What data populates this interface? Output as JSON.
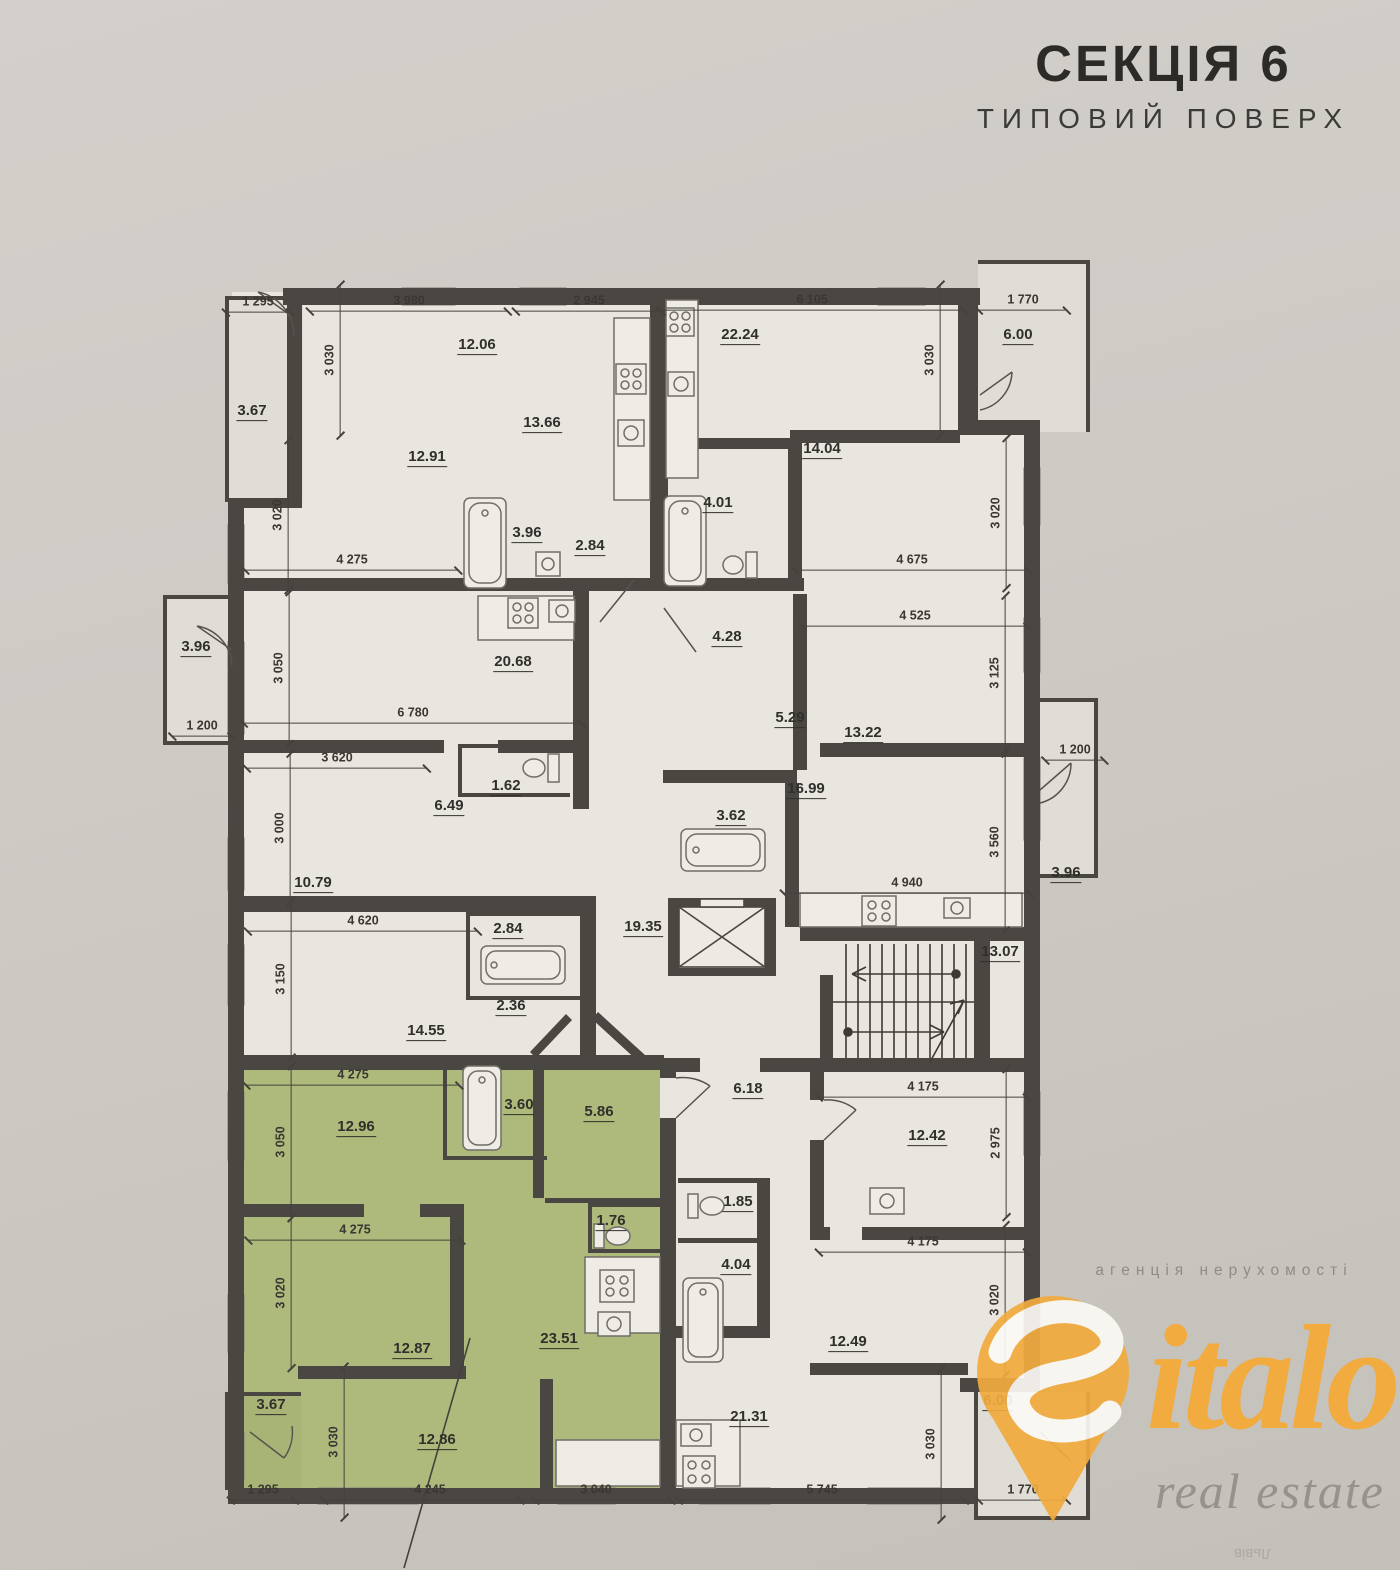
{
  "title": {
    "section": "СЕКЦІЯ 6",
    "floor_type": "ТИПОВИЙ ПОВЕРХ"
  },
  "watermark": {
    "agency_line": "агенція нерухомості",
    "brand_full": "Sitalo",
    "brand_rest": "italo",
    "tagline": "real estate",
    "city": "Львів"
  },
  "colors": {
    "wall": "#4a4642",
    "plan_bg": "#e9e6e0",
    "balcony_bg": "#e0ddd7",
    "paper": "#ccc8c2",
    "highlight_green": "#aeb97c",
    "brand_orange": "#f2ab3e"
  },
  "plan": {
    "room_areas": [
      {
        "t": "12.06",
        "x": 477,
        "y": 346
      },
      {
        "t": "13.66",
        "x": 542,
        "y": 424
      },
      {
        "t": "12.91",
        "x": 427,
        "y": 458
      },
      {
        "t": "3.96",
        "x": 527,
        "y": 534
      },
      {
        "t": "2.84",
        "x": 590,
        "y": 547
      },
      {
        "t": "3.67",
        "x": 252,
        "y": 412
      },
      {
        "t": "22.24",
        "x": 740,
        "y": 336
      },
      {
        "t": "14.04",
        "x": 822,
        "y": 450
      },
      {
        "t": "4.01",
        "x": 718,
        "y": 504
      },
      {
        "t": "6.00",
        "x": 1018,
        "y": 336
      },
      {
        "t": "4.28",
        "x": 727,
        "y": 638
      },
      {
        "t": "5.29",
        "x": 790,
        "y": 719
      },
      {
        "t": "13.22",
        "x": 863,
        "y": 734
      },
      {
        "t": "16.99",
        "x": 806,
        "y": 790
      },
      {
        "t": "3.62",
        "x": 731,
        "y": 817
      },
      {
        "t": "3.96",
        "x": 1066,
        "y": 874
      },
      {
        "t": "20.68",
        "x": 513,
        "y": 663
      },
      {
        "t": "1.62",
        "x": 506,
        "y": 787
      },
      {
        "t": "6.49",
        "x": 449,
        "y": 807
      },
      {
        "t": "10.79",
        "x": 313,
        "y": 884
      },
      {
        "t": "3.96",
        "x": 196,
        "y": 648
      },
      {
        "t": "14.55",
        "x": 426,
        "y": 1032
      },
      {
        "t": "2.84",
        "x": 508,
        "y": 930
      },
      {
        "t": "2.36",
        "x": 511,
        "y": 1007
      },
      {
        "t": "19.35",
        "x": 643,
        "y": 928
      },
      {
        "t": "13.07",
        "x": 1000,
        "y": 953
      },
      {
        "t": "12.96",
        "x": 356,
        "y": 1128
      },
      {
        "t": "3.60",
        "x": 519,
        "y": 1106
      },
      {
        "t": "5.86",
        "x": 599,
        "y": 1113
      },
      {
        "t": "1.76",
        "x": 611,
        "y": 1222
      },
      {
        "t": "12.87",
        "x": 412,
        "y": 1350
      },
      {
        "t": "23.51",
        "x": 559,
        "y": 1340
      },
      {
        "t": "12.86",
        "x": 437,
        "y": 1441
      },
      {
        "t": "3.67",
        "x": 271,
        "y": 1406
      },
      {
        "t": "6.18",
        "x": 748,
        "y": 1090
      },
      {
        "t": "1.85",
        "x": 738,
        "y": 1203
      },
      {
        "t": "4.04",
        "x": 736,
        "y": 1266
      },
      {
        "t": "12.42",
        "x": 927,
        "y": 1137
      },
      {
        "t": "12.49",
        "x": 848,
        "y": 1343
      },
      {
        "t": "21.31",
        "x": 749,
        "y": 1418
      },
      {
        "t": "6.00",
        "x": 998,
        "y": 1402
      }
    ],
    "dimensions": [
      {
        "t": "1 295",
        "x": 258,
        "y": 304,
        "o": "h"
      },
      {
        "t": "3 980",
        "x": 409,
        "y": 303,
        "o": "h"
      },
      {
        "t": "2 945",
        "x": 589,
        "y": 303,
        "o": "h"
      },
      {
        "t": "6 105",
        "x": 812,
        "y": 302,
        "o": "h"
      },
      {
        "t": "1 770",
        "x": 1023,
        "y": 302,
        "o": "h"
      },
      {
        "t": "4 275",
        "x": 352,
        "y": 562,
        "o": "h"
      },
      {
        "t": "4 675",
        "x": 912,
        "y": 562,
        "o": "h"
      },
      {
        "t": "4 525",
        "x": 915,
        "y": 618,
        "o": "h"
      },
      {
        "t": "6 780",
        "x": 413,
        "y": 715,
        "o": "h"
      },
      {
        "t": "3 620",
        "x": 337,
        "y": 760,
        "o": "h"
      },
      {
        "t": "1 200",
        "x": 202,
        "y": 728,
        "o": "h"
      },
      {
        "t": "1 200",
        "x": 1075,
        "y": 752,
        "o": "h"
      },
      {
        "t": "4 620",
        "x": 363,
        "y": 923,
        "o": "h"
      },
      {
        "t": "4 940",
        "x": 907,
        "y": 885,
        "o": "h"
      },
      {
        "t": "4 275",
        "x": 353,
        "y": 1077,
        "o": "h"
      },
      {
        "t": "4 175",
        "x": 923,
        "y": 1089,
        "o": "h"
      },
      {
        "t": "4 275",
        "x": 355,
        "y": 1232,
        "o": "h"
      },
      {
        "t": "4 175",
        "x": 923,
        "y": 1244,
        "o": "h"
      },
      {
        "t": "1 295",
        "x": 263,
        "y": 1492,
        "o": "h"
      },
      {
        "t": "4 245",
        "x": 430,
        "y": 1492,
        "o": "h"
      },
      {
        "t": "3 040",
        "x": 596,
        "y": 1492,
        "o": "h"
      },
      {
        "t": "5 745",
        "x": 822,
        "y": 1492,
        "o": "h"
      },
      {
        "t": "1 770",
        "x": 1023,
        "y": 1492,
        "o": "h"
      },
      {
        "t": "3 030",
        "x": 332,
        "y": 360,
        "o": "v"
      },
      {
        "t": "3 020",
        "x": 280,
        "y": 515,
        "o": "v"
      },
      {
        "t": "3 050",
        "x": 281,
        "y": 668,
        "o": "v"
      },
      {
        "t": "3 000",
        "x": 282,
        "y": 828,
        "o": "v"
      },
      {
        "t": "3 150",
        "x": 283,
        "y": 979,
        "o": "v"
      },
      {
        "t": "3 050",
        "x": 283,
        "y": 1142,
        "o": "v"
      },
      {
        "t": "3 020",
        "x": 283,
        "y": 1293,
        "o": "v"
      },
      {
        "t": "3 030",
        "x": 336,
        "y": 1442,
        "o": "v"
      },
      {
        "t": "3 030",
        "x": 932,
        "y": 360,
        "o": "v"
      },
      {
        "t": "3 020",
        "x": 998,
        "y": 513,
        "o": "v"
      },
      {
        "t": "3 125",
        "x": 997,
        "y": 673,
        "o": "v"
      },
      {
        "t": "3 560",
        "x": 997,
        "y": 842,
        "o": "v"
      },
      {
        "t": "2 975",
        "x": 998,
        "y": 1143,
        "o": "v"
      },
      {
        "t": "3 020",
        "x": 997,
        "y": 1300,
        "o": "v"
      },
      {
        "t": "3 030",
        "x": 933,
        "y": 1444,
        "o": "v"
      }
    ]
  }
}
